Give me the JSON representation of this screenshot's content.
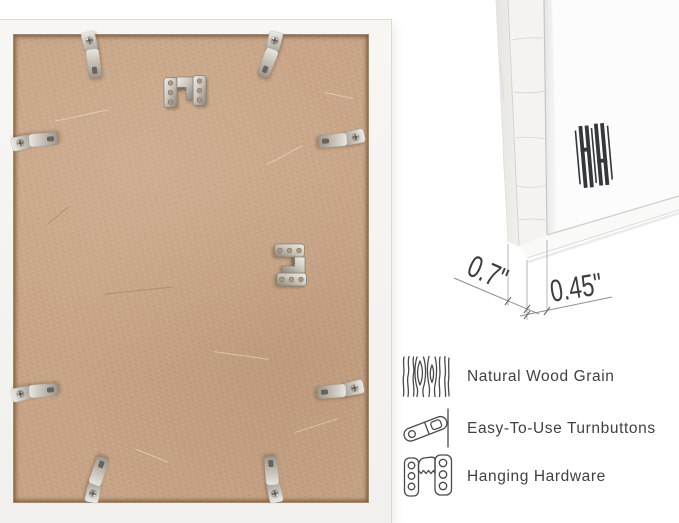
{
  "corner_detail": {
    "depth_label": "0.7\"",
    "face_label": "0.45\"",
    "logo_icon": "hh-bars-brand-logo"
  },
  "features": [
    {
      "icon": "wood-grain-icon",
      "label": "Natural Wood Grain"
    },
    {
      "icon": "turnbutton-icon",
      "label": "Easy-To-Use Turnbuttons"
    },
    {
      "icon": "hanging-hardware-icon",
      "label": "Hanging Hardware"
    }
  ],
  "back_panel": {
    "turnbutton_count": 8,
    "sawtooth_hanger_count": 2
  },
  "colors": {
    "board": "#c6a284",
    "frame_white": "#f5f4f1",
    "metal": "#c9c4bc",
    "label_text": "#414141",
    "dimension_line": "#9a9a9a",
    "logo": "#34373c"
  }
}
